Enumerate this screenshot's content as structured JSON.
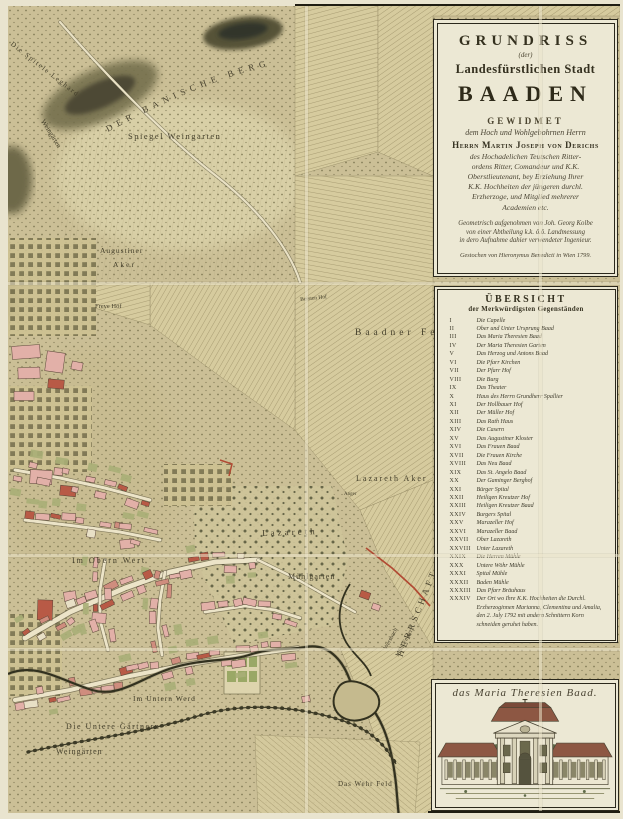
{
  "map": {
    "title_panel": {
      "title": "GRUNDRISS",
      "der": "(der)",
      "subtitle": "Landesfürstlichen Stadt",
      "city": "BAADEN",
      "dedication_heading": "GEWIDMET",
      "dedication_line": "dem Hoch und Wohlgebohrnen Herrn",
      "dedicatee": "Herrn Martin Joseph von Derichs",
      "dedication_text_1": "des Hochadelichen Teutschen Ritter-",
      "dedication_text_2": "ordens Ritter, Comandeur und K.K.",
      "dedication_text_3": "Oberstlieutenant, bey Erziehung Ihrer",
      "dedication_text_4": "K.K. Hochheiten der jüngeren durchl.",
      "dedication_text_5": "Erzherzoge, und Mitglied mehrerer",
      "dedication_text_6": "Academien etc.",
      "surveyor_1": "Geometrisch aufgenohmen von Joh. Georg Kolbe",
      "surveyor_2": "von einer Abtheilung k.k. ö.ö. Landmessung",
      "surveyor_3": "in dero Aufnahme dahier verwendeter Ingenieur.",
      "engraver_line": "Gestochen von Hieronymus Benedicti in Wien 1799."
    },
    "legend": {
      "title": "ÜBERSICHT",
      "subtitle": "der Merkwürdigsten Gegenständen",
      "items": [
        {
          "num": "I",
          "label": "Die Capelle"
        },
        {
          "num": "II",
          "label": "Ober und Unter Ursprung Baad"
        },
        {
          "num": "III",
          "label": "Das Maria Theresien Baad"
        },
        {
          "num": "IV",
          "label": "Der Maria Theresien Garten"
        },
        {
          "num": "V",
          "label": "Das Herzog und Antons Baad"
        },
        {
          "num": "VI",
          "label": "Die Pfarr Kirchen"
        },
        {
          "num": "VII",
          "label": "Der Pfarr Hof"
        },
        {
          "num": "VIII",
          "label": "Die Burg"
        },
        {
          "num": "IX",
          "label": "Das Theater"
        },
        {
          "num": "X",
          "label": "Haus des Herrn Grundherr Spallier"
        },
        {
          "num": "XI",
          "label": "Der Hollbauer Hof"
        },
        {
          "num": "XII",
          "label": "Der Müller Hof"
        },
        {
          "num": "XIII",
          "label": "Das Rath Haus"
        },
        {
          "num": "XIV",
          "label": "Die Casern"
        },
        {
          "num": "XV",
          "label": "Das Augustiner Kloster"
        },
        {
          "num": "XVI",
          "label": "Das Frauen Baad"
        },
        {
          "num": "XVII",
          "label": "Die Frauen Kirche"
        },
        {
          "num": "XVIII",
          "label": "Das Neu Baad"
        },
        {
          "num": "XIX",
          "label": "Das St. Angelo Baad"
        },
        {
          "num": "XX",
          "label": "Der Gaminger Berghof"
        },
        {
          "num": "XXI",
          "label": "Bürger Spital"
        },
        {
          "num": "XXII",
          "label": "Heiligen Kreutzer Hof"
        },
        {
          "num": "XXIII",
          "label": "Heiligen Kreutzer Baad"
        },
        {
          "num": "XXIV",
          "label": "Burgers Spital"
        },
        {
          "num": "XXV",
          "label": "Marazeller Hof"
        },
        {
          "num": "XXVI",
          "label": "Marazeller Baad"
        },
        {
          "num": "XXVII",
          "label": "Ober Lazareth"
        },
        {
          "num": "XXVIII",
          "label": "Unter Lazareth"
        },
        {
          "num": "XXIX",
          "label": "Die Herren Mühle"
        },
        {
          "num": "XXX",
          "label": "Untere Wöhr Mühle"
        },
        {
          "num": "XXXI",
          "label": "Spital Mühle"
        },
        {
          "num": "XXXII",
          "label": "Baden Mühle"
        },
        {
          "num": "XXXIII",
          "label": "Das Pfarr Bräuhaus"
        },
        {
          "num": "XXXIV",
          "label": "Der Ort wo Ihre K.K. Hochheiten die Durchl. Erzherzoginnen Marianna, Clementina und Amalia, den 2. July 1792 mit andern Schnittern Korn schneiden geruhet haben."
        }
      ]
    },
    "vignette": {
      "caption": "das Maria Theresien Baad."
    },
    "labels": [
      "Die Spitele Leghard",
      "DER BANISCHE BERG",
      "Spiegel Weingarten",
      "Weingärten",
      "Augustiner",
      "Aker",
      "Freye Höf",
      "Baadner Feld",
      "Bersten Hof",
      "Lazareth Aker",
      "Anger",
      "Lazareth",
      "Im Obern Wert",
      "Mühlgarten",
      "Wersbach",
      "Mühl Felder",
      "HERRSCHAFT LEESDORF",
      "Im Untern Werd",
      "Die Untere Gärtnern",
      "Weingärten",
      "Das Wehr Feld"
    ]
  },
  "colors": {
    "paper": "#cbbf96",
    "panel": "#ece8d4",
    "ink": "#2e2b1d",
    "river": "#32311f",
    "boundary_red": "#b14a33",
    "building_pink": "#e2b0a8",
    "roof_red": "#b85a46",
    "vignette_roof": "#8d5743"
  }
}
